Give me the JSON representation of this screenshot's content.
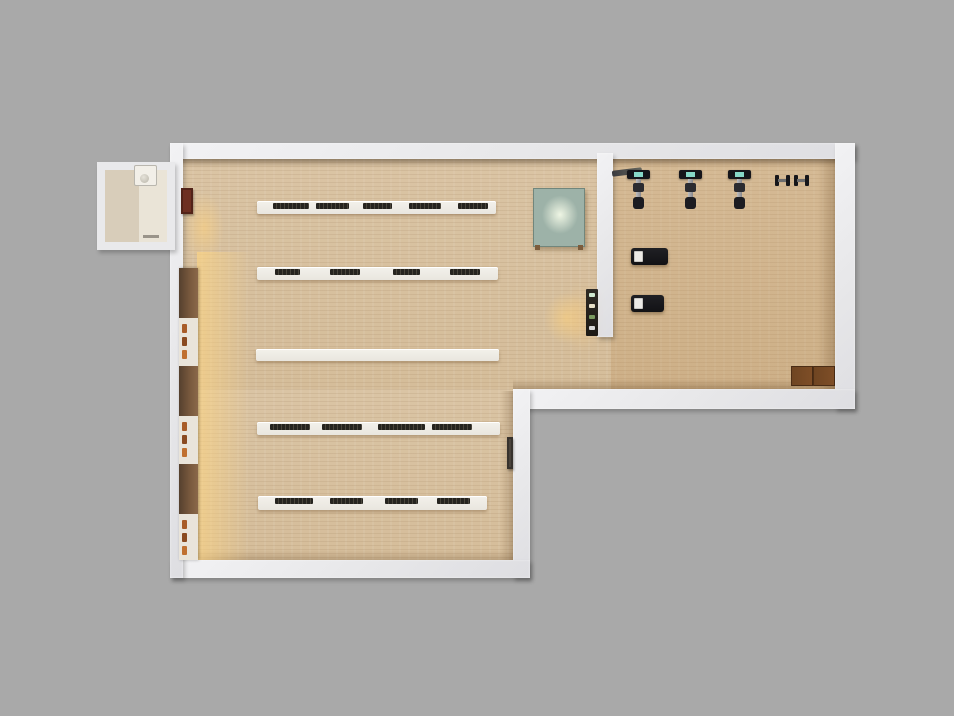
{
  "scene": {
    "name": "interior-floorplan-top-view-render",
    "rooms": [
      {
        "name": "entry-vestibule"
      },
      {
        "name": "library-shelving-room"
      },
      {
        "name": "gym-equipment-room"
      }
    ],
    "palette": {
      "bg": "#a9a9a9",
      "wall": "#e7e7e9",
      "floor": "#dac4a4",
      "vfloor": "#d8cdba",
      "shelf": "#e9e6df",
      "book": "#26241f",
      "teal": "#9db2a8",
      "screen": "#86d7c7",
      "wood": "#6f4522",
      "glow": "#ffd682"
    },
    "objects": [
      {
        "name": "wall-cabinet-red",
        "kind": "cabinet",
        "x": 181,
        "y": 188,
        "w": 12,
        "h": 26,
        "color": "#6e2f22"
      },
      {
        "name": "wall-bookcase-lit",
        "kind": "bookcase",
        "x": 179,
        "y": 268,
        "w": 19,
        "h": 292
      },
      {
        "name": "display-table-teal",
        "kind": "table",
        "x": 533,
        "y": 188,
        "w": 50,
        "h": 57
      },
      {
        "name": "shelf-row-1",
        "kind": "shelf",
        "x": 257,
        "y": 201,
        "w": 239,
        "h": 13,
        "groups": [
          [
            16,
            36
          ],
          [
            59,
            33
          ],
          [
            106,
            29
          ],
          [
            152,
            32
          ],
          [
            201,
            30
          ]
        ]
      },
      {
        "name": "shelf-row-2",
        "kind": "shelf",
        "x": 257,
        "y": 267,
        "w": 241,
        "h": 13,
        "groups": [
          [
            18,
            25
          ],
          [
            73,
            30
          ],
          [
            136,
            27
          ],
          [
            193,
            30
          ]
        ]
      },
      {
        "name": "shelf-row-3-empty",
        "kind": "shelf",
        "x": 256,
        "y": 349,
        "w": 243,
        "h": 12,
        "groups": []
      },
      {
        "name": "shelf-row-4",
        "kind": "shelf",
        "x": 257,
        "y": 422,
        "w": 243,
        "h": 13,
        "groups": [
          [
            13,
            40
          ],
          [
            65,
            40
          ],
          [
            121,
            47
          ],
          [
            175,
            40
          ]
        ]
      },
      {
        "name": "shelf-row-5",
        "kind": "shelf",
        "x": 258,
        "y": 496,
        "w": 229,
        "h": 14,
        "groups": [
          [
            17,
            38
          ],
          [
            72,
            33
          ],
          [
            127,
            33
          ],
          [
            179,
            33
          ]
        ]
      },
      {
        "name": "display-case-divider",
        "kind": "case",
        "x": 586,
        "y": 289,
        "w": 12,
        "h": 47
      },
      {
        "name": "wall-rail",
        "kind": "cabinet",
        "x": 507,
        "y": 437,
        "w": 6,
        "h": 32,
        "color": "#4a433c"
      },
      {
        "name": "barbell-rack",
        "kind": "bar",
        "x": 612,
        "y": 169,
        "w": 30,
        "h": 6
      },
      {
        "name": "exercise-bike-1",
        "kind": "bike",
        "x": 624,
        "y": 170,
        "w": 30,
        "h": 40
      },
      {
        "name": "exercise-bike-2",
        "kind": "bike",
        "x": 676,
        "y": 170,
        "w": 30,
        "h": 40
      },
      {
        "name": "exercise-bike-3",
        "kind": "bike",
        "x": 725,
        "y": 170,
        "w": 30,
        "h": 40
      },
      {
        "name": "dumbbell-pair",
        "kind": "dumbbells",
        "x": 775,
        "y": 174,
        "w": 34,
        "h": 13
      },
      {
        "name": "exercise-bench-1",
        "kind": "bench",
        "x": 631,
        "y": 248,
        "w": 37,
        "h": 17
      },
      {
        "name": "exercise-bench-2",
        "kind": "bench",
        "x": 631,
        "y": 295,
        "w": 33,
        "h": 17
      },
      {
        "name": "wood-bench",
        "kind": "woodbench",
        "x": 791,
        "y": 366,
        "w": 43,
        "h": 18
      },
      {
        "name": "sink-fixture",
        "kind": "fixture",
        "x": 134,
        "y": 165,
        "w": 21,
        "h": 19
      }
    ]
  }
}
